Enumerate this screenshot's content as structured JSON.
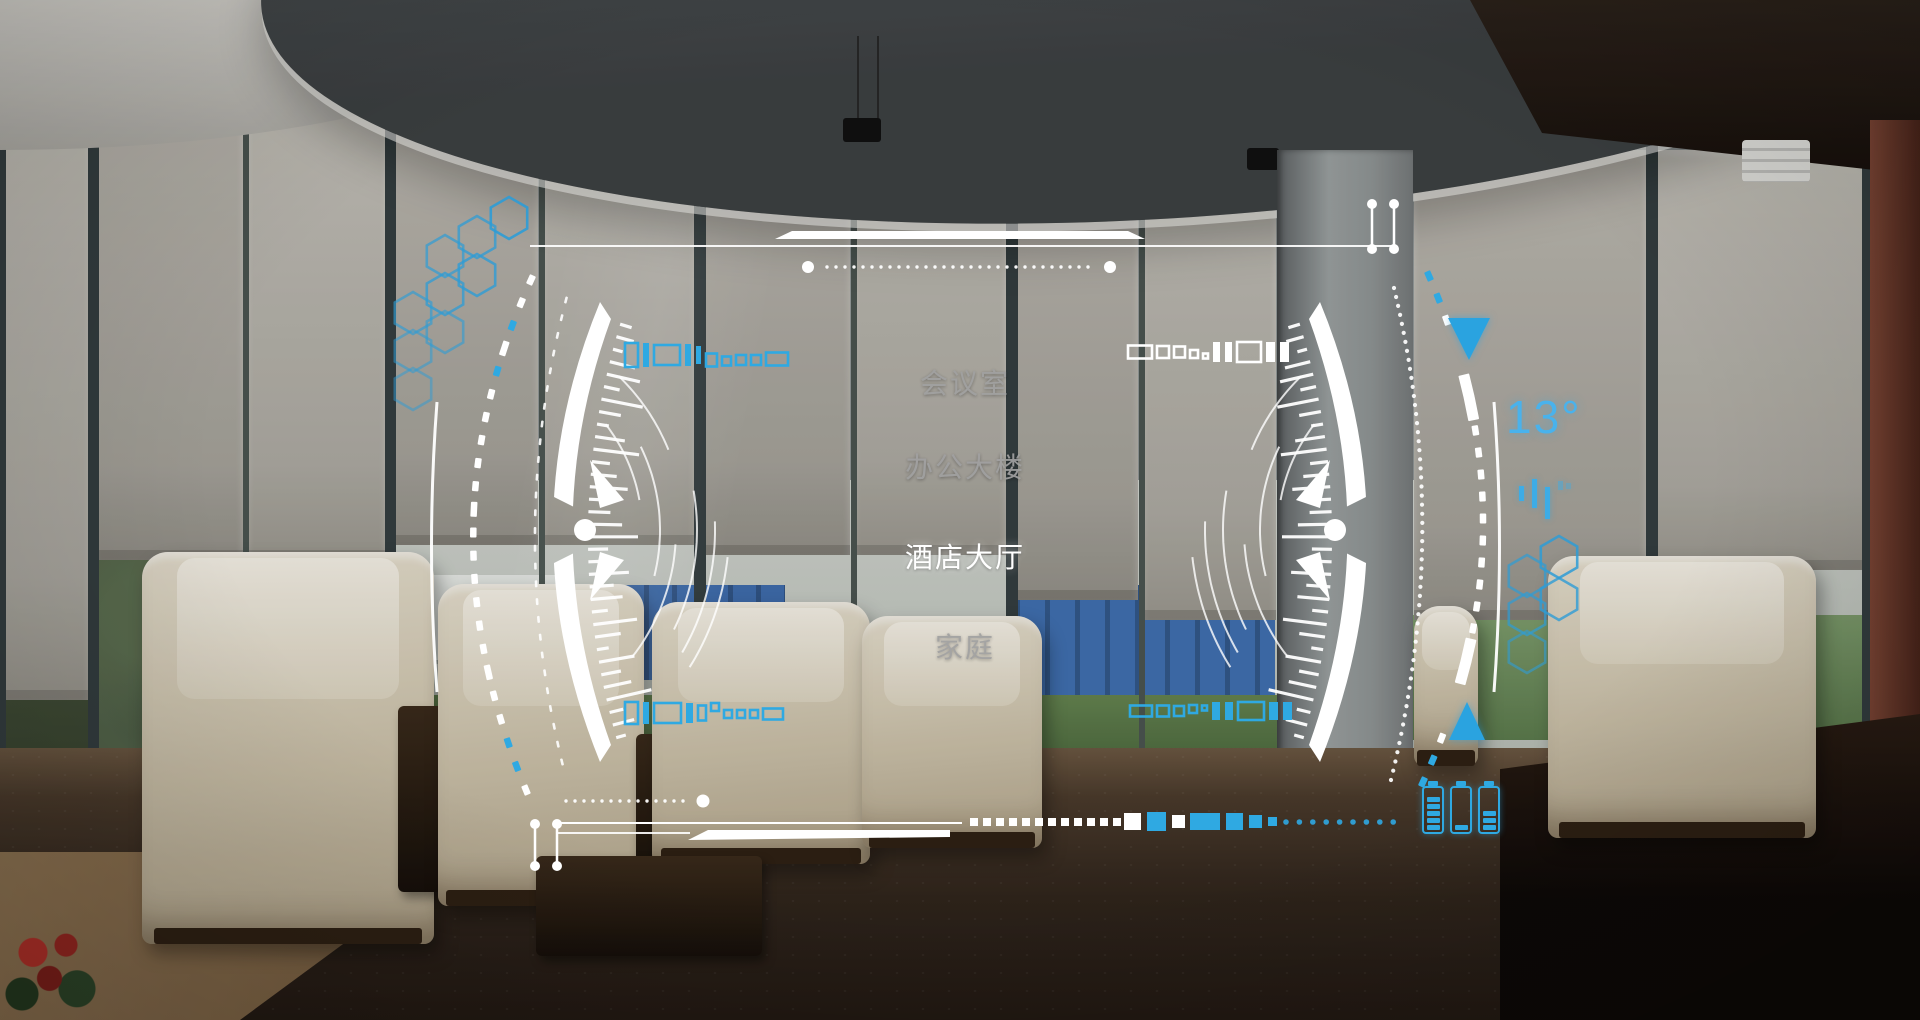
{
  "hud": {
    "menu": {
      "items": [
        {
          "label": "会议室",
          "active": false
        },
        {
          "label": "办公大楼",
          "active": false
        },
        {
          "label": "酒店大厅",
          "active": true
        },
        {
          "label": "家庭",
          "active": false
        }
      ]
    },
    "weather": {
      "temperature": "13°"
    },
    "power": {
      "batteries": [
        {
          "bars": 5,
          "max": 5
        },
        {
          "bars": 1,
          "max": 5
        },
        {
          "bars": 3,
          "max": 5
        }
      ]
    },
    "colors": {
      "accent": "#2fa9e2",
      "active_text": "#ffffff",
      "inactive_text": "#a0a0a0"
    },
    "icons": {
      "scroll_up": "triangle-up-icon",
      "scroll_down": "triangle-down-icon",
      "battery": "battery-icon",
      "signal": "signal-bars-icon",
      "decor": "hexagon-cluster"
    }
  }
}
